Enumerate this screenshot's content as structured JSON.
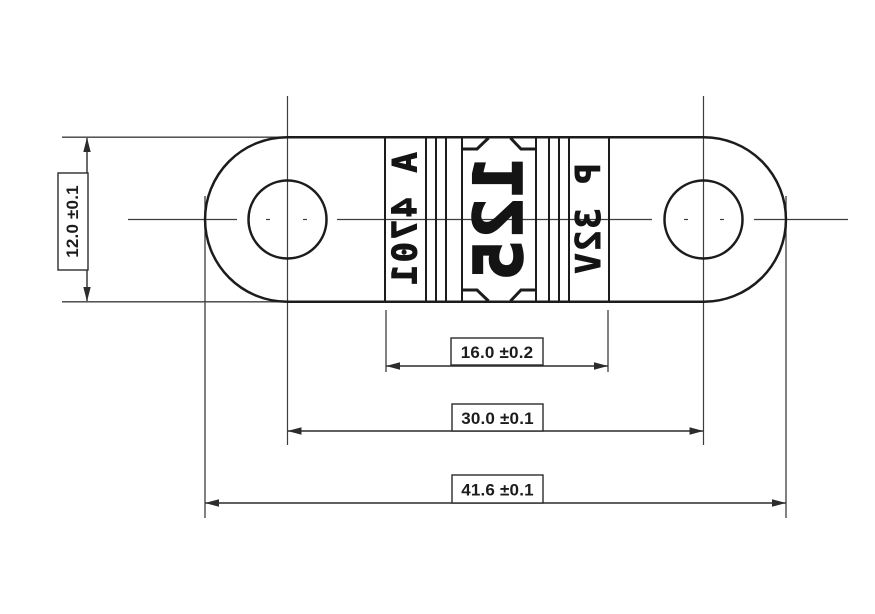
{
  "markings": {
    "left": "A 4701",
    "center": "125",
    "right": "P 32V"
  },
  "dimensions": {
    "height": "12.0 ±0.1",
    "element_width": "16.0 ±0.2",
    "hole_spacing": "30.0 ±0.1",
    "overall_length": "41.6 ±0.1"
  },
  "colors": {
    "outline": "#1c1c1c",
    "thin_line": "#3d3d3d",
    "background": "#ffffff"
  }
}
